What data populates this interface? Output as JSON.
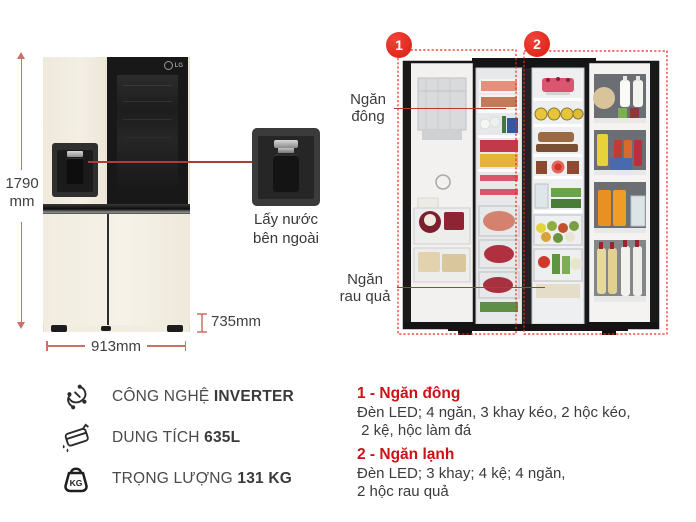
{
  "colors": {
    "accent_red": "#e42314",
    "dimension_red": "#cd6f66",
    "heading_red": "#cc1216",
    "body_cream": "#f2ede1",
    "text_dark": "#3e3e3e"
  },
  "product": {
    "brand_logo": "LG",
    "dimensions": {
      "height_value": "1790",
      "height_unit": "mm",
      "width": "913mm",
      "depth": "735mm"
    },
    "callout": {
      "line1": "Lấy nước",
      "line2": "bên ngoài"
    },
    "open_view": {
      "badge_freezer": "1",
      "badge_fridge": "2",
      "label_freezer_line1": "Ngăn",
      "label_freezer_line2": "đông",
      "label_crisper_line1": "Ngăn",
      "label_crisper_line2": "rau quả"
    }
  },
  "features": [
    {
      "icon": "inverter-icon",
      "label": "CÔNG NGHỆ",
      "value": "INVERTER"
    },
    {
      "icon": "capacity-icon",
      "label": "DUNG TÍCH",
      "value": "635L"
    },
    {
      "icon": "weight-icon",
      "label": "TRỌNG LƯỢNG",
      "value": "131 KG"
    }
  ],
  "icons": {
    "weight_badge": "KG"
  },
  "compartment_notes": [
    {
      "title": "1 - Ngăn đông",
      "line1": "Đèn LED; 4 ngăn, 3 khay kéo, 2 hộc kéo,",
      "line2": " 2 kệ, hộc làm đá"
    },
    {
      "title": "2 - Ngăn lạnh",
      "line1": "Đèn LED; 3 khay; 4 kệ; 4 ngăn,",
      "line2": "2 hộc rau quả"
    }
  ]
}
